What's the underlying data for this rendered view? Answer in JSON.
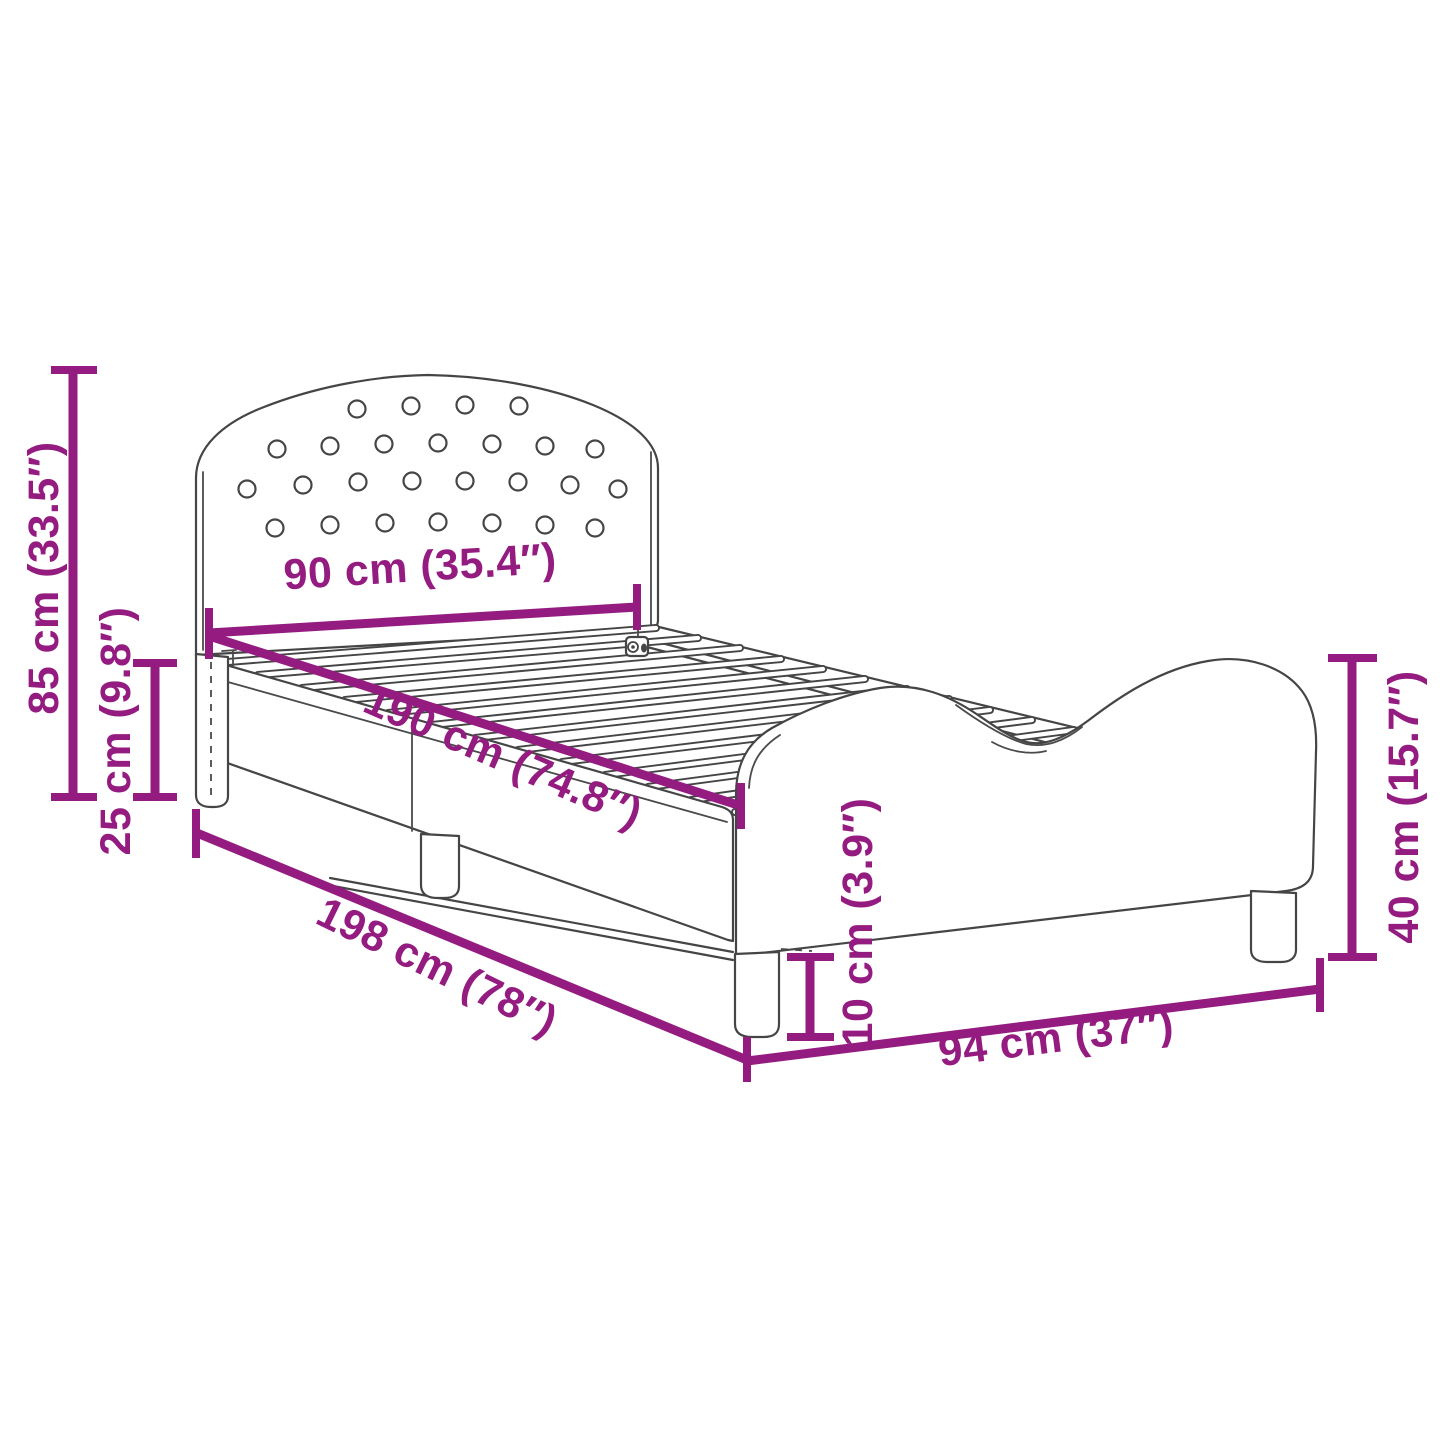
{
  "diagram": {
    "type": "product-dimension-diagram",
    "subject": "kids bed frame with button-tufted headboard, slatted base and wavy side panel",
    "colors": {
      "dimension_lines": "#941B80",
      "line_art": "#454545",
      "background": "#FFFFFF"
    },
    "dimensions": {
      "headboard_height": "85 cm (33.5″)",
      "rail_top_height": "25 cm (9.8″)",
      "bed_width": "90 cm (35.4″)",
      "sleeping_length": "190 cm (74.8″)",
      "total_length": "198 cm (78″)",
      "total_width": "94 cm (37″)",
      "leg_height": "10 cm (3.9″)",
      "side_panel_height": "40 cm (15.7″)"
    }
  }
}
